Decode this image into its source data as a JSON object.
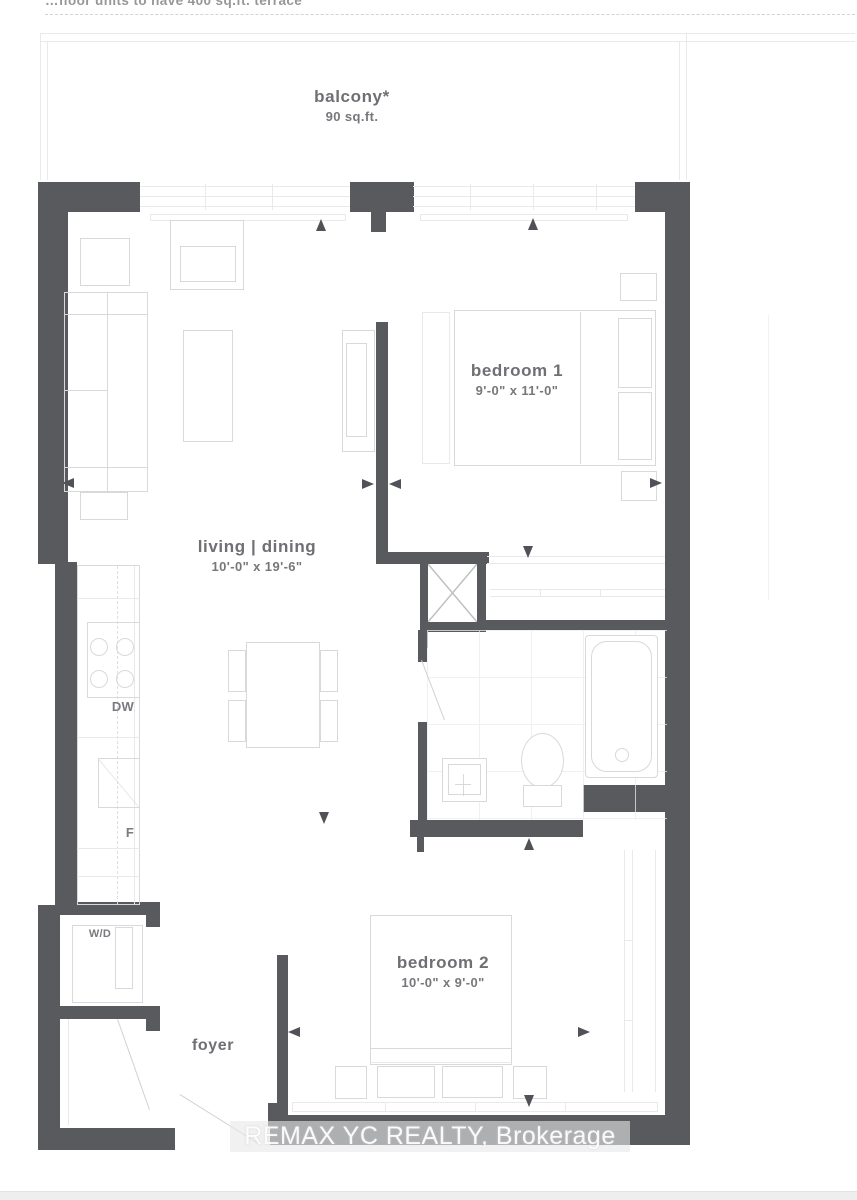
{
  "document": {
    "type": "condo floor plan",
    "top_note": "…floor units to have 400 sq.ft. terrace",
    "watermark": "REMAX YC REALTY, Brokerage"
  },
  "rooms": {
    "balcony": {
      "label": "balcony*",
      "area": "90 sq.ft."
    },
    "bedroom1": {
      "label": "bedroom 1",
      "dims": "9'-0\" x 11'-0\""
    },
    "living_dining": {
      "label": "living | dining",
      "dims": "10'-0\" x 19'-6\""
    },
    "bedroom2": {
      "label": "bedroom 2",
      "dims": "10'-0\" x 9'-0\""
    },
    "foyer": {
      "label": "foyer"
    }
  },
  "appliances": {
    "dishwasher": "DW",
    "fridge": "F",
    "washer_dryer": "W/D"
  },
  "colors": {
    "wall": "#595a5e",
    "furniture_line": "#d9d9dc",
    "label_text": "#6f6f74",
    "watermark_text": "#fdfdfd"
  }
}
